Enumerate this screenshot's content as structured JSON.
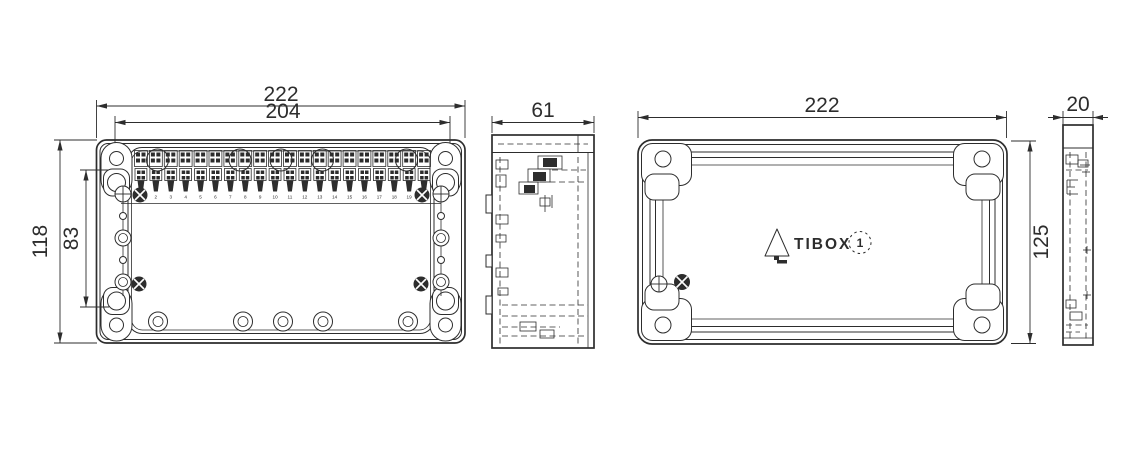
{
  "canvas": {
    "background": "#ffffff",
    "line_color": "#2d2d2d"
  },
  "dimensions": {
    "base_width": "222",
    "base_inner_width": "204",
    "base_height": "118",
    "base_hole_spacing": "83",
    "base_depth": "61",
    "cover_width": "222",
    "cover_height": "125",
    "cover_depth": "20"
  },
  "terminals": {
    "numbers": [
      "1",
      "2",
      "3",
      "4",
      "5",
      "6",
      "7",
      "8",
      "9",
      "10",
      "11",
      "12",
      "13",
      "14",
      "15",
      "16",
      "17",
      "18",
      "19",
      "20"
    ]
  },
  "logo": {
    "brand": "TIBOX",
    "badge_number": "1"
  }
}
